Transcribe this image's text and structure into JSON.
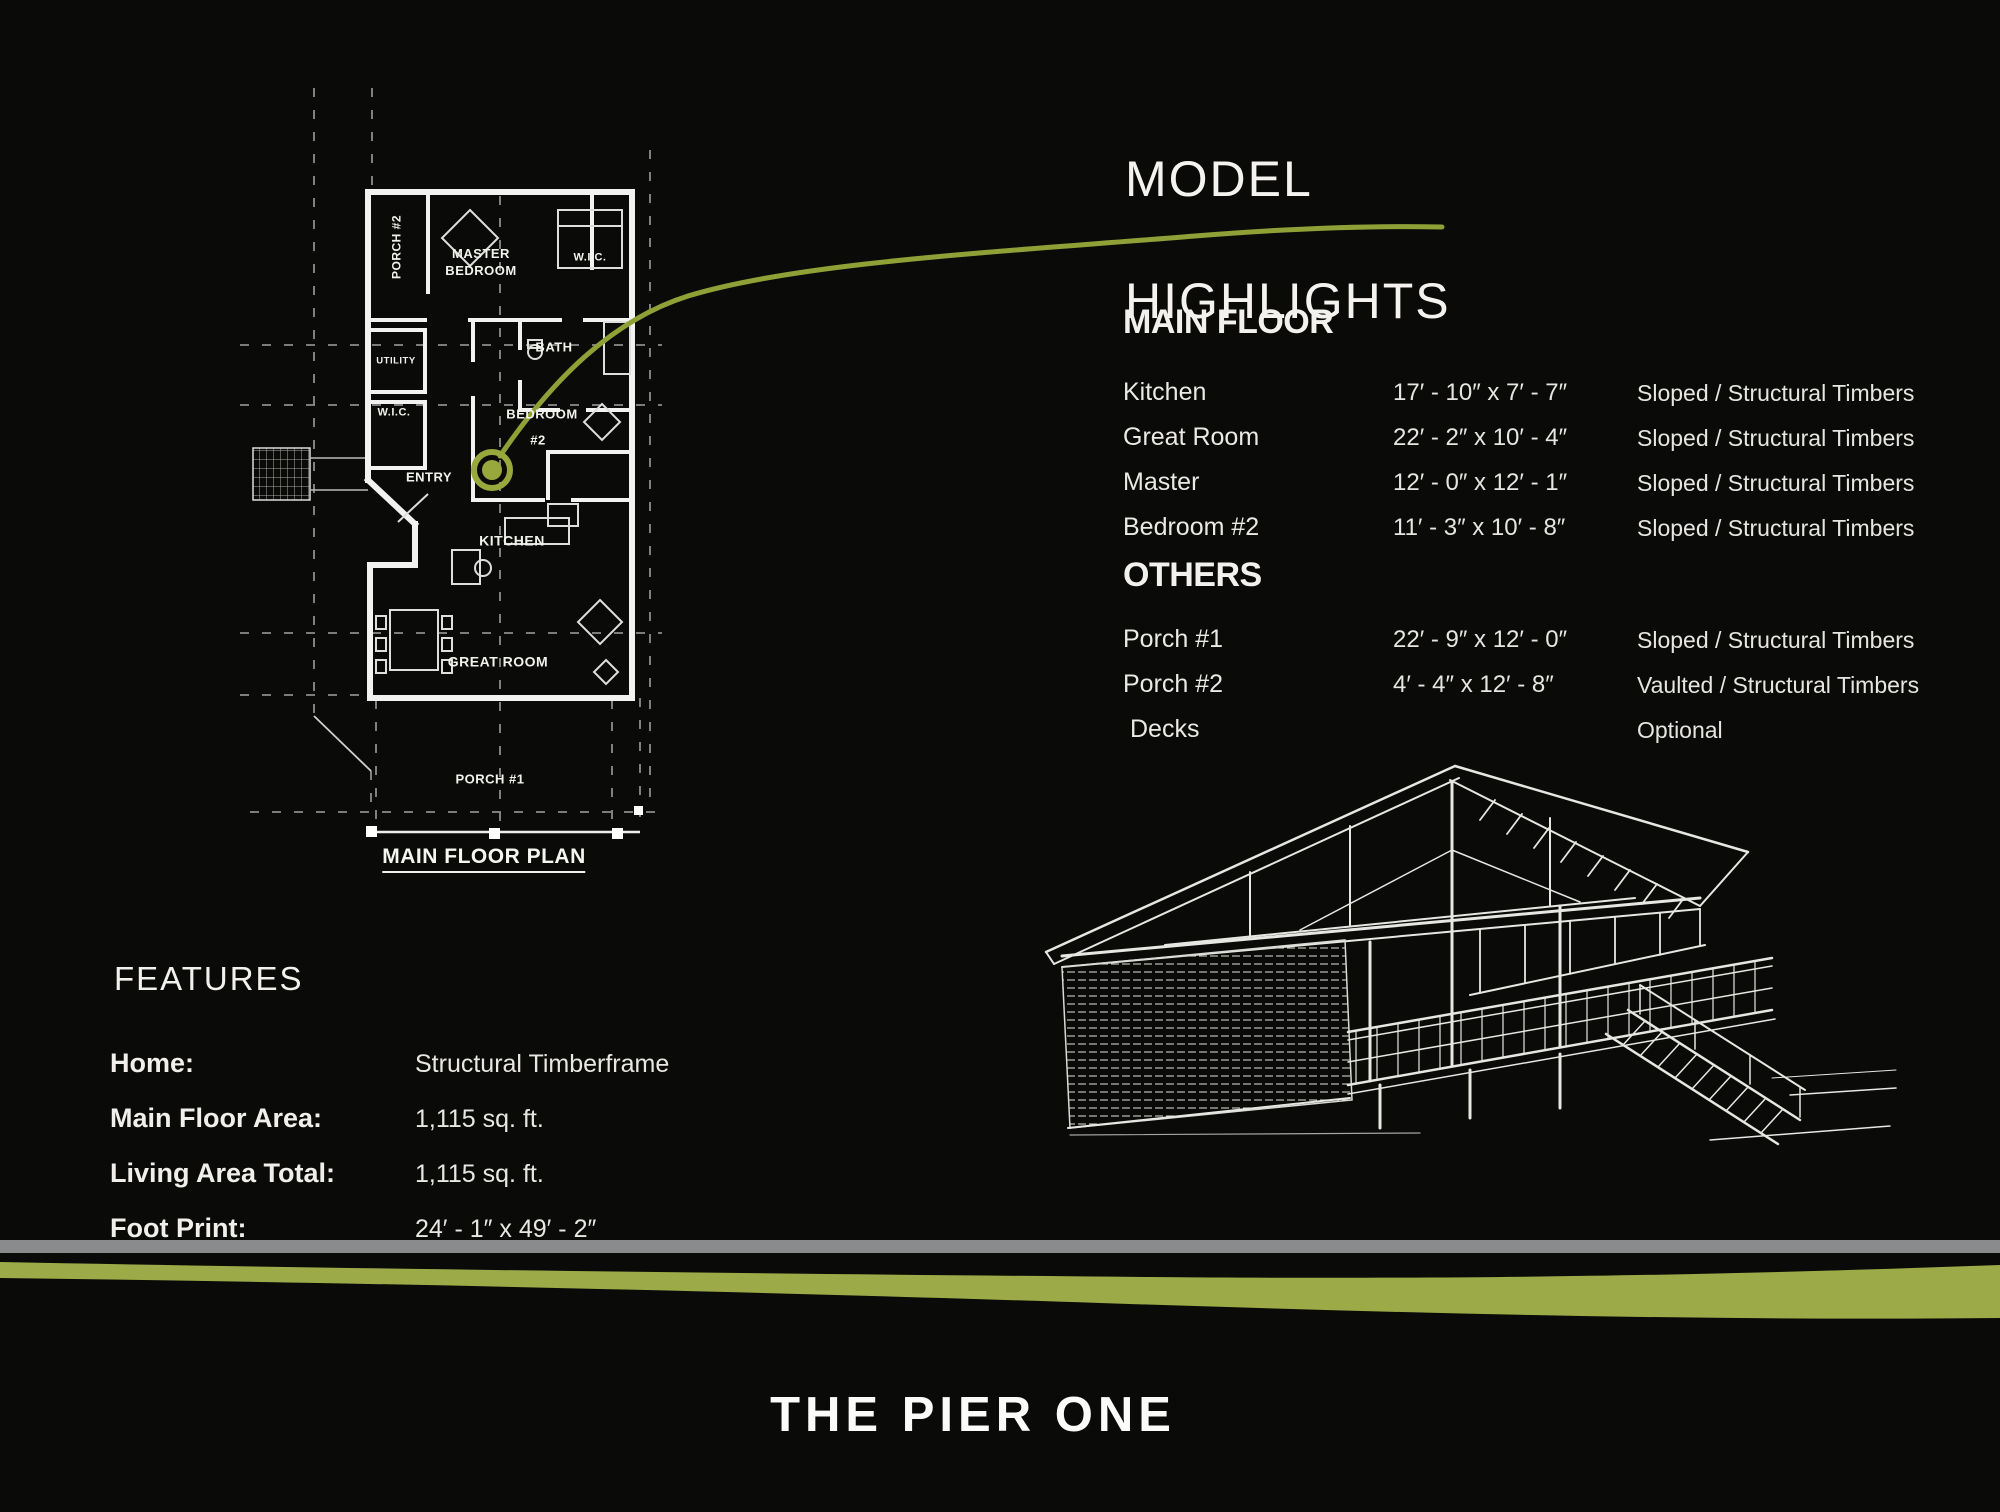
{
  "colors": {
    "background": "#0a0a08",
    "accent_green": "#9CAB47",
    "swoosh_green": "#8FA036",
    "gray_bar": "#8A8B8D",
    "line_white": "#F2F2F0"
  },
  "plan": {
    "labels": {
      "porch2": "PORCH #2",
      "master_l1": "MASTER",
      "master_l2": "BEDROOM",
      "wic_top": "W.I.C.",
      "utility": "UTILITY",
      "bath": "BATH",
      "wic_left": "W.I.C.",
      "entry": "ENTRY",
      "bedroom2_l1": "BEDROOM",
      "bedroom2_l2": "#2",
      "kitchen": "KITCHEN",
      "great_room": "GREAT ROOM",
      "porch1": "PORCH #1",
      "caption": "MAIN FLOOR PLAN"
    }
  },
  "highlights": {
    "title_line1": "MODEL",
    "title_line2": "HIGHLIGHTS",
    "main_floor": {
      "heading": "MAIN FLOOR",
      "rows": [
        {
          "name": "Kitchen",
          "dims": "17′ - 10″ x 7′ - 7″",
          "ceiling": "Sloped / Structural Timbers"
        },
        {
          "name": "Great Room",
          "dims": "22′ - 2″ x 10′ - 4″",
          "ceiling": "Sloped / Structural Timbers"
        },
        {
          "name": "Master",
          "dims": "12′ - 0″ x 12′ - 1″",
          "ceiling": "Sloped / Structural Timbers"
        },
        {
          "name": "Bedroom #2",
          "dims": "11′ - 3″ x 10′ - 8″",
          "ceiling": "Sloped / Structural Timbers"
        }
      ]
    },
    "others": {
      "heading": "OTHERS",
      "rows": [
        {
          "name": "Porch #1",
          "dims": "22′ - 9″ x 12′ - 0″",
          "ceiling": "Sloped / Structural Timbers"
        },
        {
          "name": "Porch #2",
          "dims": "4′ - 4″ x 12′ - 8″",
          "ceiling": "Vaulted / Structural Timbers"
        },
        {
          "name": "Decks",
          "dims": "",
          "ceiling": "Optional"
        }
      ]
    }
  },
  "features": {
    "heading": "FEATURES",
    "rows": [
      {
        "label": "Home:",
        "value": "Structural Timberframe"
      },
      {
        "label": "Main Floor Area:",
        "value": "1,115 sq. ft."
      },
      {
        "label": "Living Area Total:",
        "value": "1,115 sq. ft."
      },
      {
        "label": "Foot Print:",
        "value": "24′ - 1″ x 49′ - 2″"
      }
    ]
  },
  "footer": {
    "title": "THE PIER ONE"
  }
}
